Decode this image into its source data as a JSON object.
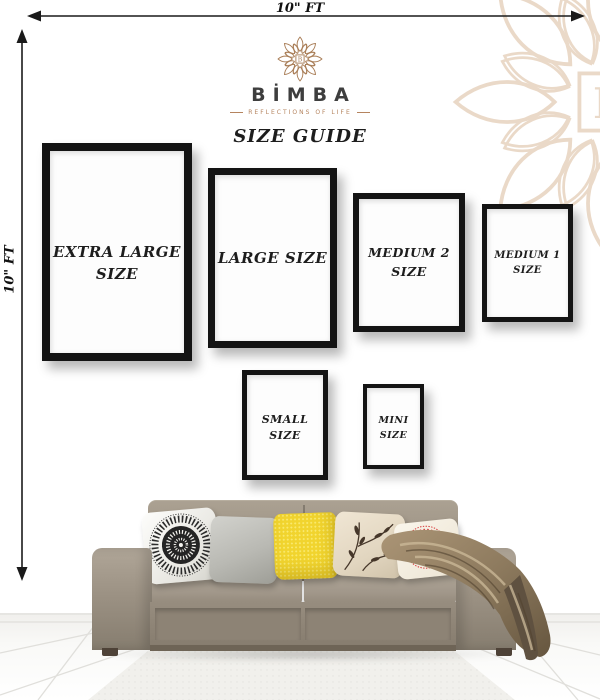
{
  "scene": {
    "wall_width_label": "10\" FT",
    "wall_height_label": "10\" FT"
  },
  "brand": {
    "name": "BİMBA",
    "tagline": "REFLECTIONS OF LIFE",
    "heading": "SIZE GUIDE"
  },
  "frames": [
    {
      "id": "extra-large",
      "line1": "EXTRA LARGE",
      "line2": "SIZE"
    },
    {
      "id": "large",
      "line1": "LARGE SIZE",
      "line2": ""
    },
    {
      "id": "medium-2",
      "line1": "MEDIUM 2",
      "line2": "SIZE"
    },
    {
      "id": "medium-1",
      "line1": "MEDIUM 1",
      "line2": "SIZE"
    },
    {
      "id": "small",
      "line1": "SMALL",
      "line2": "SIZE"
    },
    {
      "id": "mini",
      "line1": "MINI",
      "line2": "SIZE"
    }
  ],
  "icons": {
    "logo": "flower-mandala-icon",
    "watermark": "flower-mandala-watermark-icon",
    "top_arrow": "horizontal-dimension-arrow",
    "left_arrow": "vertical-dimension-arrow"
  },
  "colors": {
    "accent_brown": "#a87c55",
    "tagline_brown": "#b5845f",
    "watermark_tan": "#ead9c8",
    "frame_black": "#141414",
    "text_black": "#1d1d1d",
    "sofa_taupe": "#9c9284",
    "pillow_gray": "#b9b9b3",
    "pillow_yellow": "#f1d42e",
    "pillow_red": "#d6393b",
    "throw_bronze": "#8d7a5e"
  }
}
